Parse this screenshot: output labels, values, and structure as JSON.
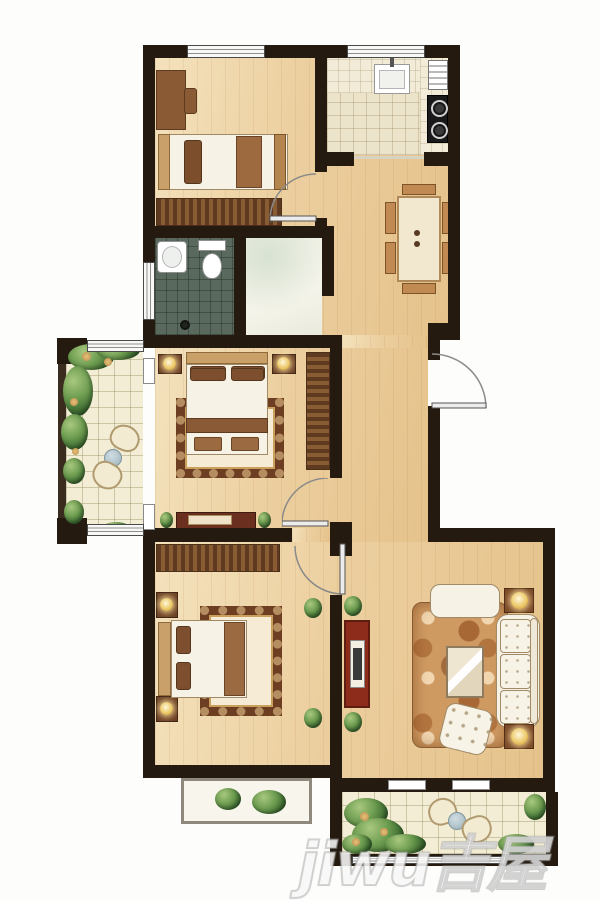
{
  "watermark": {
    "text": "jiwu吉屋"
  },
  "colors": {
    "wall": "#241a10",
    "floor-light": "#f4e2bd",
    "floor-dark": "#e5c28b",
    "bath-tile": "#5a695e",
    "kitchen-tile": "#ece3cb",
    "balcony-tile": "#f2edd4",
    "plant-green": "#4e7d3c",
    "accent-red": "#8e2c1c",
    "rug-brown": "#6e3e22",
    "wood-brown": "#8a5a35"
  },
  "rooms": [
    {
      "id": "bedroom-top-left",
      "label": "bedroom"
    },
    {
      "id": "kitchen",
      "label": "kitchen"
    },
    {
      "id": "dining-area",
      "label": "dining area"
    },
    {
      "id": "bathroom",
      "label": "bathroom"
    },
    {
      "id": "utility-room",
      "label": "utility room"
    },
    {
      "id": "master-bedroom",
      "label": "master bedroom"
    },
    {
      "id": "balcony-left",
      "label": "balcony"
    },
    {
      "id": "hallway",
      "label": "hallway"
    },
    {
      "id": "bedroom-bottom-left",
      "label": "bedroom"
    },
    {
      "id": "living-room",
      "label": "living room"
    },
    {
      "id": "balcony-bottom",
      "label": "balcony"
    }
  ]
}
